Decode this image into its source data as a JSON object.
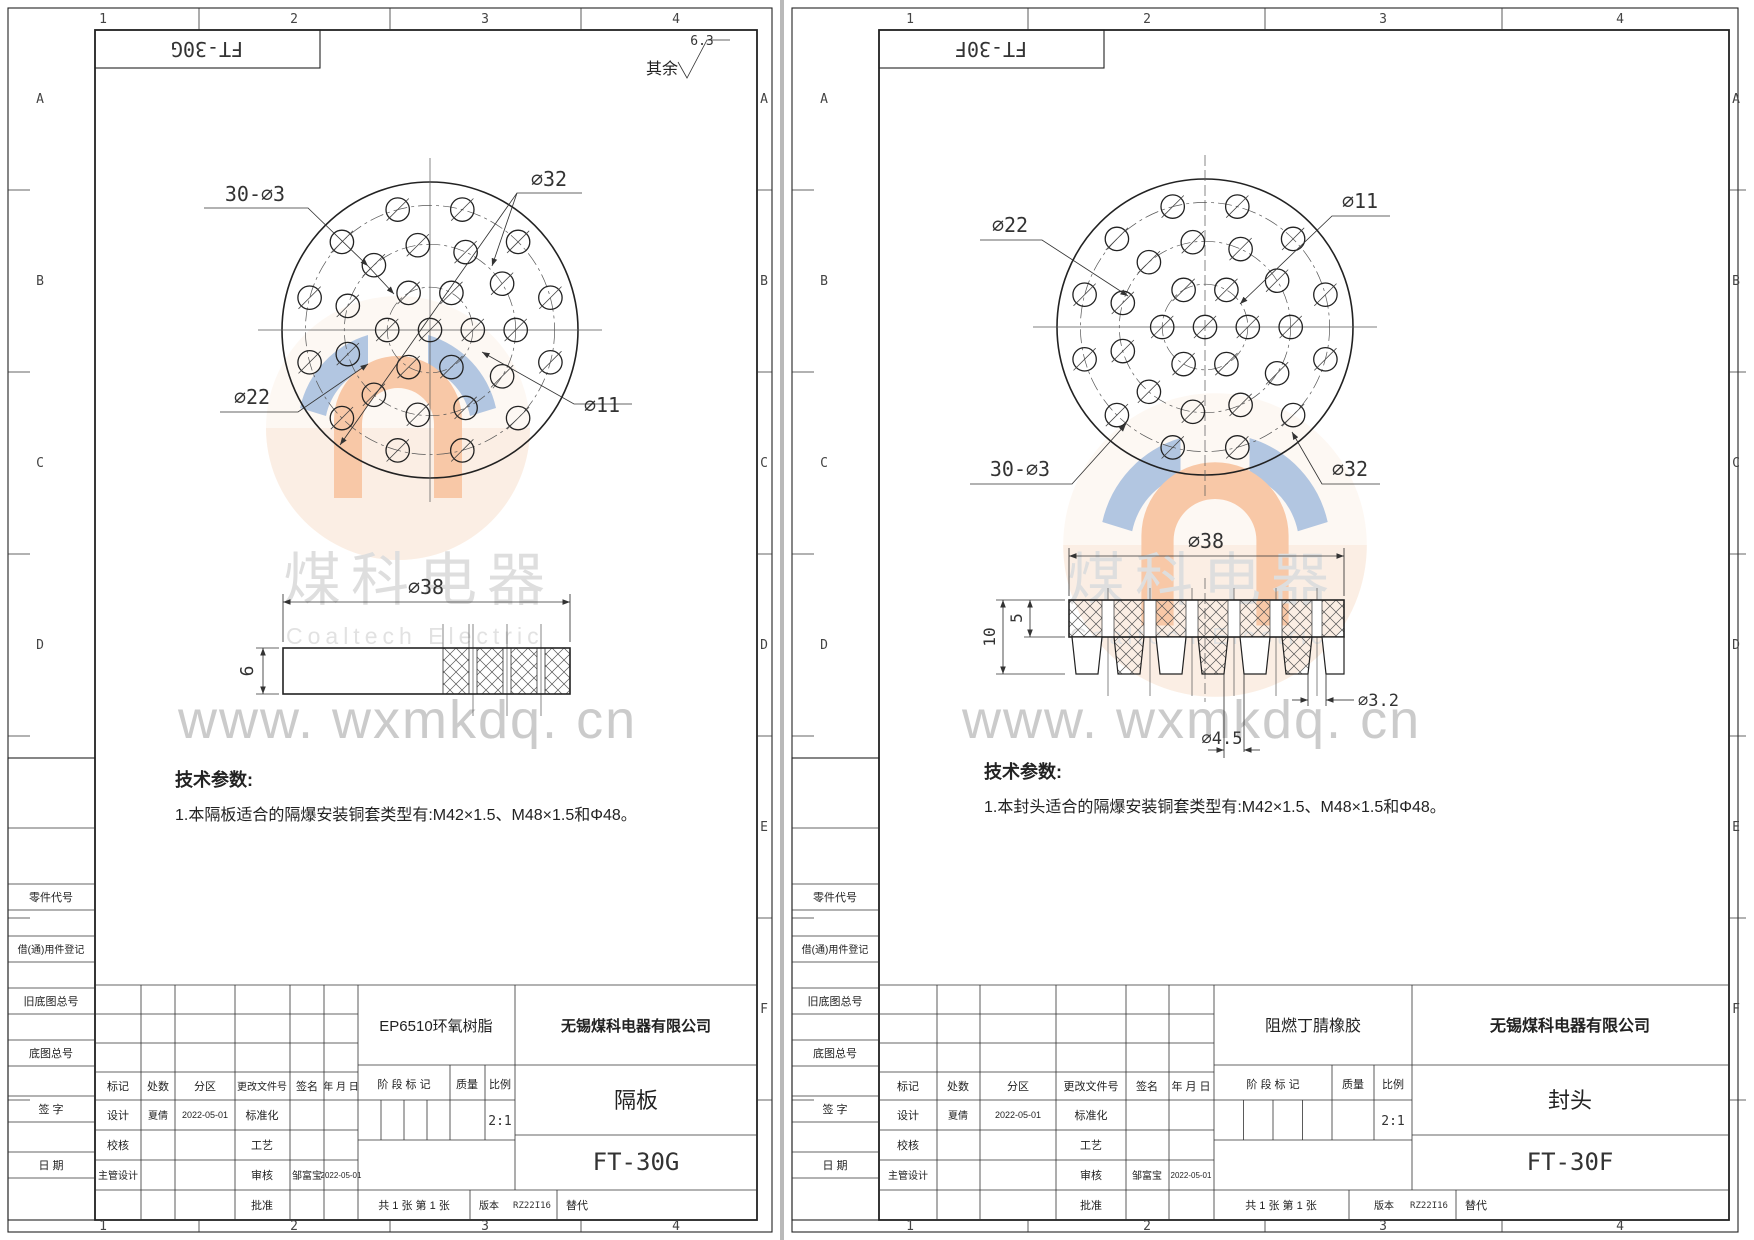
{
  "common": {
    "zones": {
      "cols": [
        "1",
        "2",
        "3",
        "4"
      ],
      "rows": [
        "A",
        "B",
        "C",
        "D",
        "E",
        "F"
      ]
    },
    "margin_labels": [
      "零件代号",
      "借(通)用件登记",
      "旧底图总号",
      "底图总号",
      "签 字",
      "日 期"
    ],
    "tb_labels": {
      "mark": "标记",
      "count": "处数",
      "zone": "分区",
      "change_doc": "更改文件号",
      "sign": "签名",
      "date": "年 月 日",
      "stage": "阶 段 标 记",
      "quality": "质量",
      "scale": "比例",
      "design": "设计",
      "standardize": "标准化",
      "check": "校核",
      "process": "工艺",
      "chief": "主管设计",
      "audit": "审核",
      "approve": "批准",
      "version": "版本",
      "replace": "替代"
    },
    "hole_pattern": {
      "note": "30-⌀3",
      "outer_d_mm": 38,
      "hole_d_mm": 3,
      "center_hole": true,
      "rings": [
        {
          "d_mm": 11,
          "count": 6,
          "start_deg": 0
        },
        {
          "d_mm": 22,
          "count": 11,
          "start_deg": 0
        },
        {
          "d_mm": 32,
          "count": 12,
          "start_deg": 15
        }
      ]
    },
    "watermark": {
      "cn": "煤科电器",
      "en": "Coaltech Electric",
      "url": "www. wxmkdq. cn"
    }
  },
  "sheets": [
    {
      "doc_no": "FT-30G",
      "surface_note": {
        "prefix": "其余",
        "value": "6.3"
      },
      "dims": {
        "holes": "30-⌀3",
        "bc_outer": "⌀32",
        "bc_mid": "⌀22",
        "bc_inner": "⌀11",
        "od": "⌀38",
        "thickness": "6"
      },
      "tech": {
        "title": "技术参数:",
        "line1": "1.本隔板适合的隔爆安装铜套类型有:M42×1.5、M48×1.5和Φ48。"
      },
      "tb": {
        "material": "EP6510环氧树脂",
        "company": "无锡煤科电器有限公司",
        "part_name": "隔板",
        "drawing_no": "FT-30G",
        "scale": "2:1",
        "designer": "夏倩",
        "design_date": "2022-05-01",
        "auditor": "邹富宝",
        "audit_date": "2022-05-01",
        "version": "RZ22I16",
        "sheet_note": "共 1 张 第 1 张"
      }
    },
    {
      "doc_no": "FT-30F",
      "dims": {
        "holes": "30-⌀3",
        "bc_outer": "⌀32",
        "bc_mid": "⌀22",
        "bc_inner": "⌀11",
        "od": "⌀38",
        "total_h": "10",
        "band_h": "5",
        "hole_bottom": "⌀4.5",
        "hole_top": "⌀3.2"
      },
      "tech": {
        "title": "技术参数:",
        "line1": "1.本封头适合的隔爆安装铜套类型有:M42×1.5、M48×1.5和Φ48。"
      },
      "tb": {
        "material": "阻燃丁腈橡胶",
        "company": "无锡煤科电器有限公司",
        "part_name": "封头",
        "drawing_no": "FT-30F",
        "scale": "2:1",
        "designer": "夏倩",
        "design_date": "2022-05-01",
        "auditor": "邹富宝",
        "audit_date": "2022-05-01",
        "version": "RZ22I16",
        "sheet_note": "共 1 张 第 1 张"
      }
    }
  ]
}
